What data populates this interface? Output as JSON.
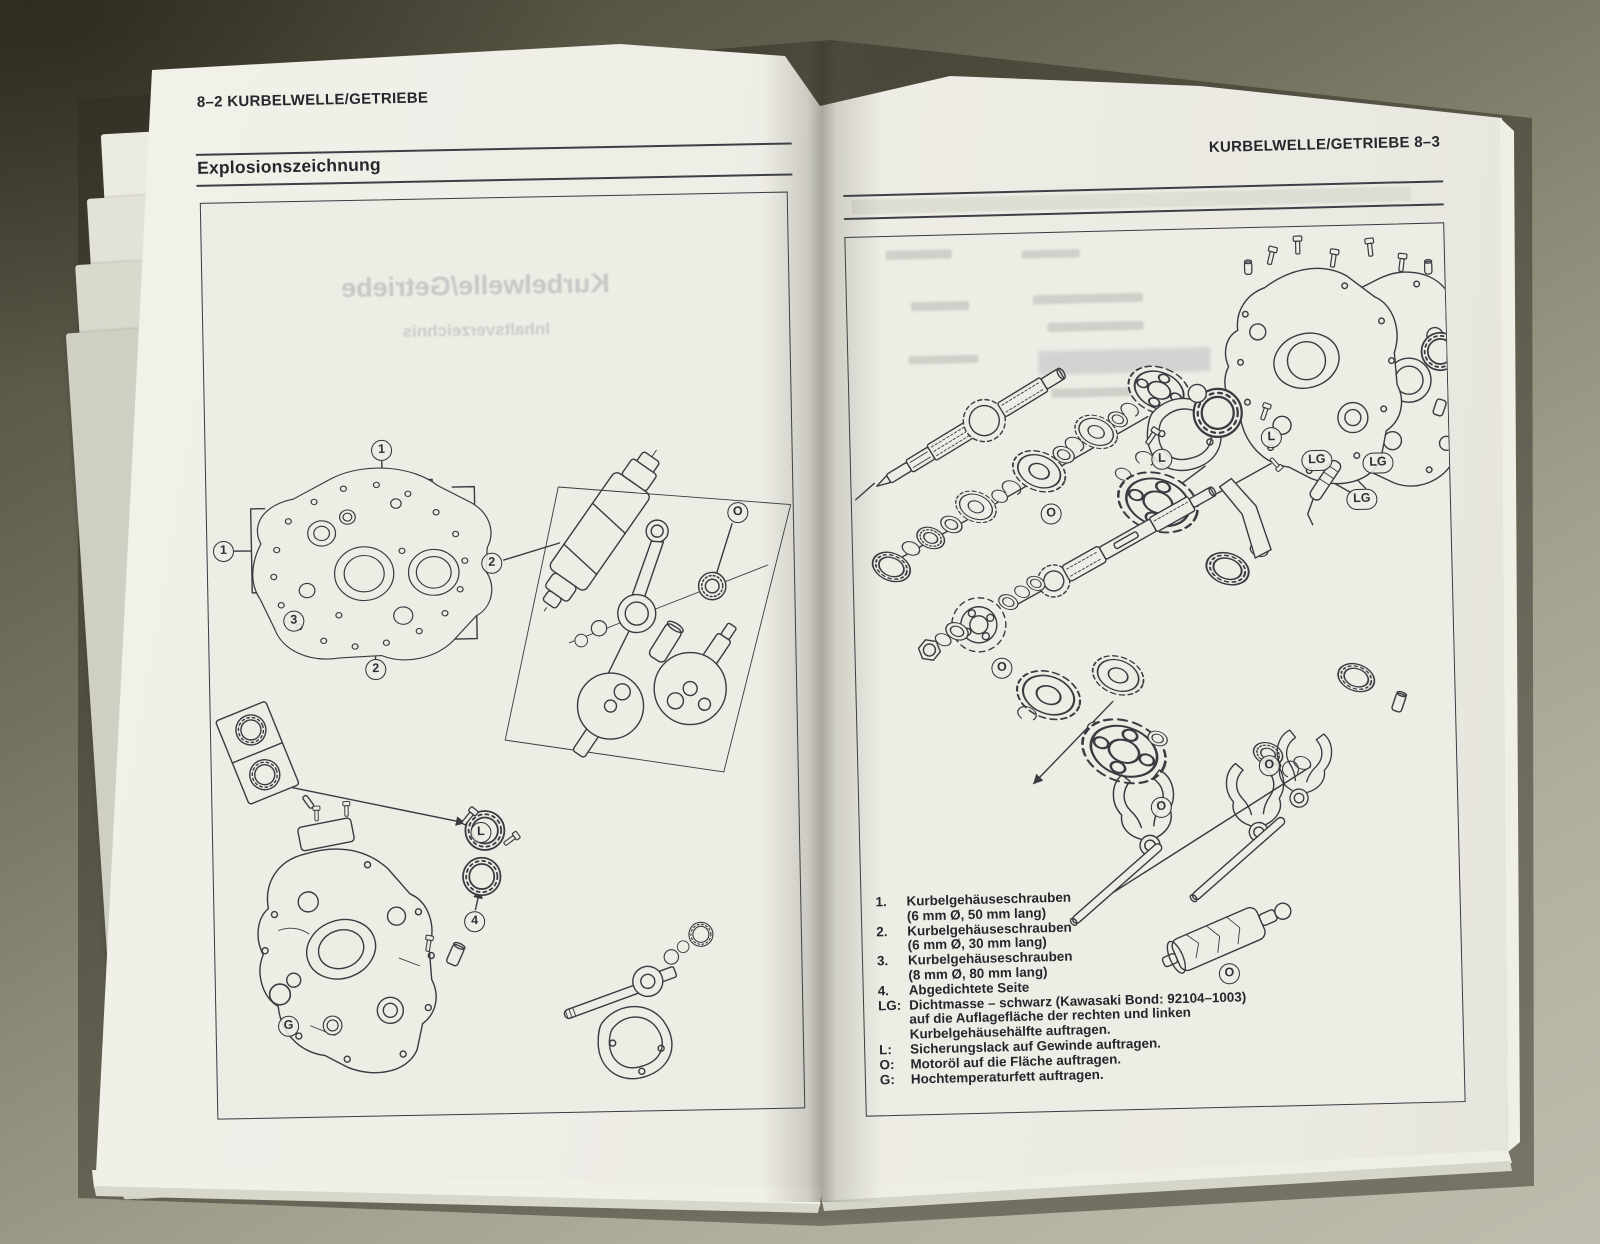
{
  "colors": {
    "table_dark": "#514e3e",
    "table_light": "#b9b8a7",
    "paper": "#edece5",
    "ink": "#2f2f36"
  },
  "book": {
    "left_page": {
      "page_header": "8–2 KURBELWELLE/GETRIEBE",
      "section_title": "Explosionszeichnung",
      "ghost_title": "Kurbelwelle/Getriebe",
      "ghost_subtitle": "Inhaltsverzeichnis",
      "callouts": [
        {
          "label": "1"
        },
        {
          "label": "1"
        },
        {
          "label": "2"
        },
        {
          "label": "3"
        },
        {
          "label": "2"
        },
        {
          "label": "O"
        },
        {
          "label": "L"
        },
        {
          "label": "4"
        },
        {
          "label": "G"
        }
      ]
    },
    "right_page": {
      "page_header": "KURBELWELLE/GETRIEBE 8–3",
      "legend": [
        {
          "key": "1.",
          "text": "Kurbelgehäuseschrauben"
        },
        {
          "key": "",
          "text": "(6 mm Ø, 50 mm lang)"
        },
        {
          "key": "2.",
          "text": "Kurbelgehäuseschrauben"
        },
        {
          "key": "",
          "text": "(6 mm Ø, 30 mm lang)"
        },
        {
          "key": "3.",
          "text": "Kurbelgehäuseschrauben"
        },
        {
          "key": "",
          "text": "(8 mm Ø, 80 mm lang)"
        },
        {
          "key": "4.",
          "text": "Abgedichtete Seite"
        },
        {
          "key": "LG:",
          "text": "Dichtmasse – schwarz (Kawasaki Bond: 92104–1003)"
        },
        {
          "key": "",
          "text": "auf die Auflagefläche der rechten und linken"
        },
        {
          "key": "",
          "text": "Kurbelgehäusehälfte auftragen."
        },
        {
          "key": "L:",
          "text": "Sicherungslack auf Gewinde auftragen."
        },
        {
          "key": "O:",
          "text": "Motoröl auf die Fläche auftragen."
        },
        {
          "key": "G:",
          "text": "Hochtemperaturfett auftragen."
        }
      ],
      "callouts": [
        {
          "label": "L"
        },
        {
          "label": "LG"
        },
        {
          "label": "LG"
        },
        {
          "label": "LG"
        },
        {
          "label": "L"
        },
        {
          "label": "O"
        },
        {
          "label": "O"
        },
        {
          "label": "O"
        },
        {
          "label": "O"
        },
        {
          "label": "O"
        }
      ]
    }
  }
}
